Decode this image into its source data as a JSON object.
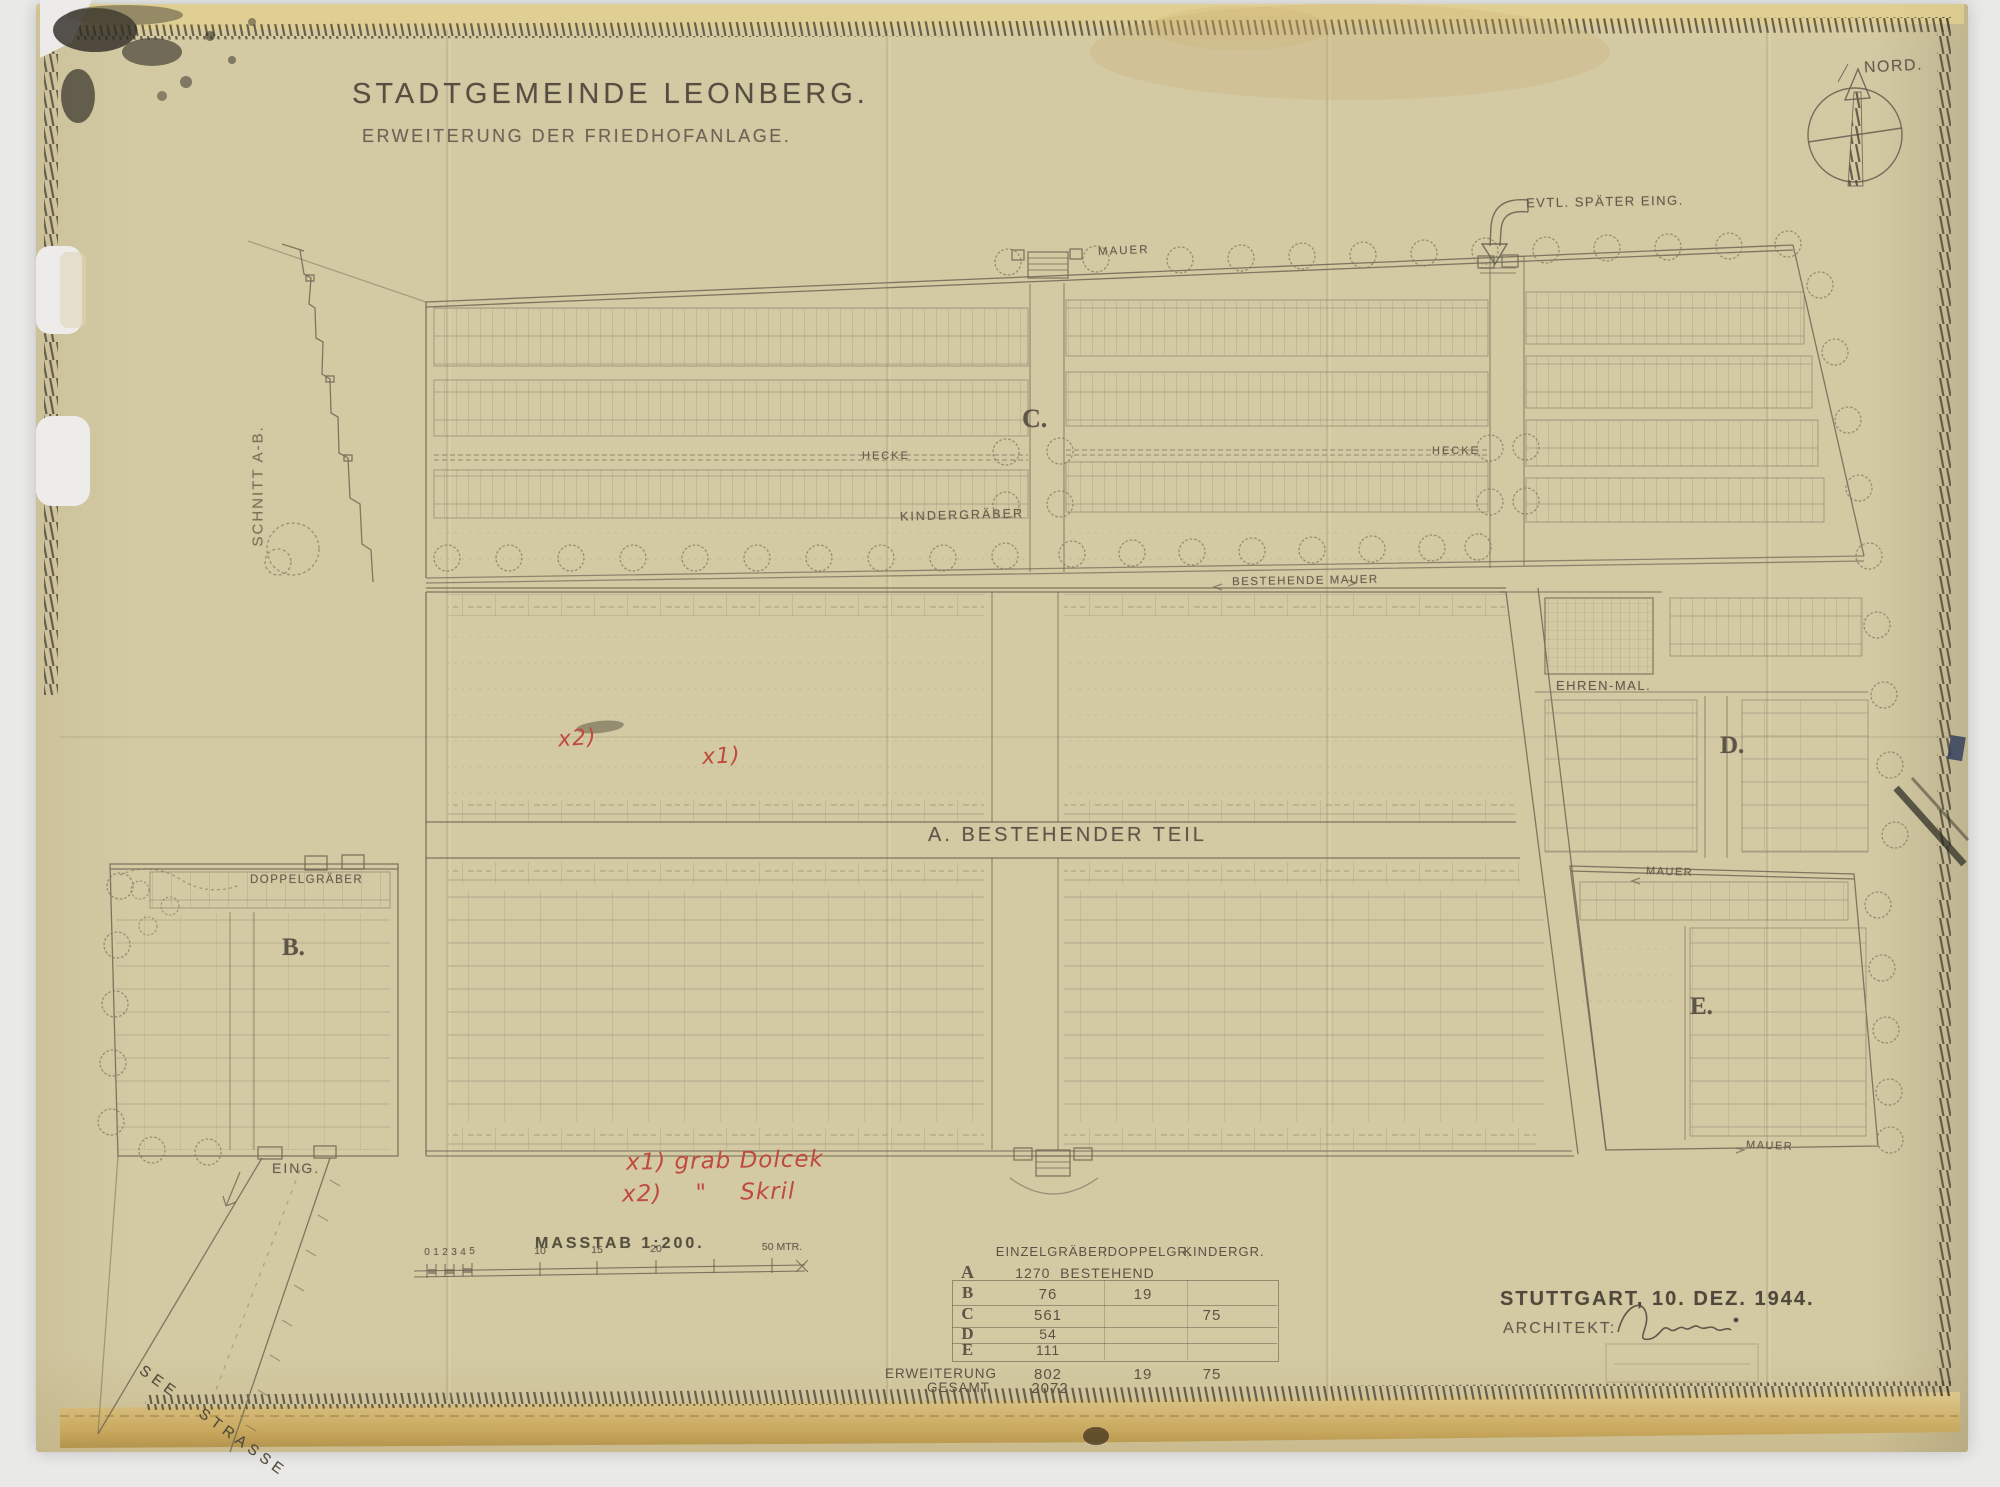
{
  "titleblock": {
    "title": "STADTGEMEINDE LEONBERG.",
    "subtitle": "ERWEITERUNG DER FRIEDHOFANLAGE."
  },
  "compass": {
    "label": "NORD."
  },
  "annotations": {
    "later_entrance": "EVTL. SPÄTER EING.",
    "mauer_top": "MAUER",
    "bestehende_mauer": "BESTEHENDE MAUER",
    "hecke_left": "HECKE",
    "hecke_right": "HECKE",
    "kindergraeber": "KINDERGRÄBER",
    "doppelgraeber": "DOPPELGRÄBER",
    "ehrenmal": "EHREN-MAL.",
    "mauer_e_top": "MAUER",
    "mauer_e_bottom": "MAUER",
    "entrance": "EING.",
    "street": "SEE - STRASSE",
    "schnitt": "SCHNITT A-B."
  },
  "sections": {
    "a": "A. BESTEHENDER TEIL",
    "b": "B.",
    "c": "C.",
    "d": "D.",
    "e": "E."
  },
  "red_marks": {
    "mark1": "x1)",
    "mark2": "x2)",
    "note1": "x1) grab Dolcek",
    "note2": "x2)    \"    Skril"
  },
  "scale": {
    "label": "MASSTAB 1:200.",
    "ticks": [
      "0",
      "1",
      "2",
      "3",
      "4",
      "5",
      "10",
      "15",
      "20",
      "50 MTR."
    ]
  },
  "table": {
    "col_headers": [
      "EINZELGRÄBER",
      "DOPPELGR.",
      "KINDERGR."
    ],
    "rows": [
      {
        "label": "A",
        "einzel": "1270  BESTEHEND",
        "doppel": "",
        "kinder": ""
      },
      {
        "label": "B",
        "einzel": "76",
        "doppel": "19",
        "kinder": ""
      },
      {
        "label": "C",
        "einzel": "561",
        "doppel": "",
        "kinder": "75"
      },
      {
        "label": "D",
        "einzel": "54",
        "doppel": "",
        "kinder": ""
      },
      {
        "label": "E",
        "einzel": "111",
        "doppel": "",
        "kinder": ""
      }
    ],
    "totals": [
      {
        "label": "ERWEITERUNG",
        "einzel": "802",
        "doppel": "19",
        "kinder": "75"
      },
      {
        "label": "GESAMT",
        "einzel": "2072",
        "doppel": "",
        "kinder": ""
      }
    ]
  },
  "signblock": {
    "place_date": "STUTTGART, 10. DEZ. 1944.",
    "architect_label": "ARCHITEKT:"
  },
  "colors": {
    "paper": "#d3caa4",
    "ink": "#6f6754",
    "red_annotation": "#c04a3e",
    "border_hatch": "#4e4637"
  }
}
